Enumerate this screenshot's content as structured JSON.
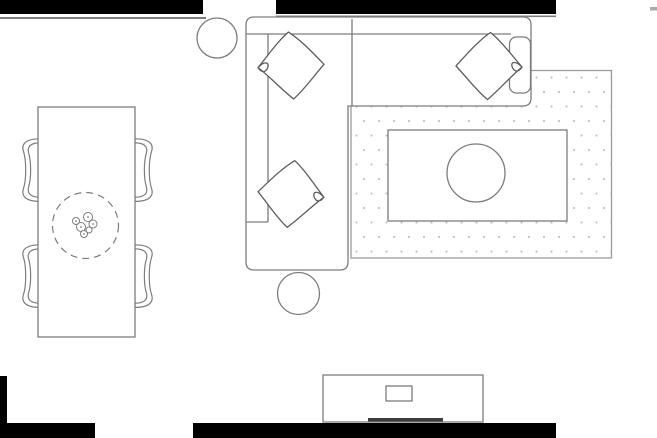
{
  "meta": {
    "label": "living-room-floor-plan"
  },
  "canvas": {
    "width": 657,
    "height": 438
  },
  "palette": {
    "background": "#ffffff",
    "wall": "#000000",
    "outline": "#7d7d7d",
    "outline_dark": "#5c5c5c",
    "outline_light": "#aaaaaa",
    "rug_border": "#9a9a9a",
    "rug_dot": "#c2c2c2",
    "soundbar": "#3d3d3d"
  },
  "objects": {
    "walls": [
      {
        "name": "wall-top-left"
      },
      {
        "name": "wall-top-right"
      },
      {
        "name": "wall-tick-top-right-corner"
      },
      {
        "name": "wall-bottom-left-corner"
      },
      {
        "name": "wall-bottom-center"
      }
    ],
    "furniture": [
      {
        "name": "round-side-table",
        "count": 1
      },
      {
        "name": "sectional-sofa",
        "count": 1
      },
      {
        "name": "throw-pillow",
        "count": 3
      },
      {
        "name": "ottoman",
        "count": 1
      },
      {
        "name": "area-rug",
        "count": 1
      },
      {
        "name": "coffee-table",
        "count": 1
      },
      {
        "name": "dining-table",
        "count": 1
      },
      {
        "name": "dining-chair",
        "count": 4
      },
      {
        "name": "table-centerpiece",
        "count": 1
      },
      {
        "name": "tv-stand",
        "count": 1
      },
      {
        "name": "tv",
        "count": 1
      },
      {
        "name": "soundbar",
        "count": 1
      }
    ]
  }
}
